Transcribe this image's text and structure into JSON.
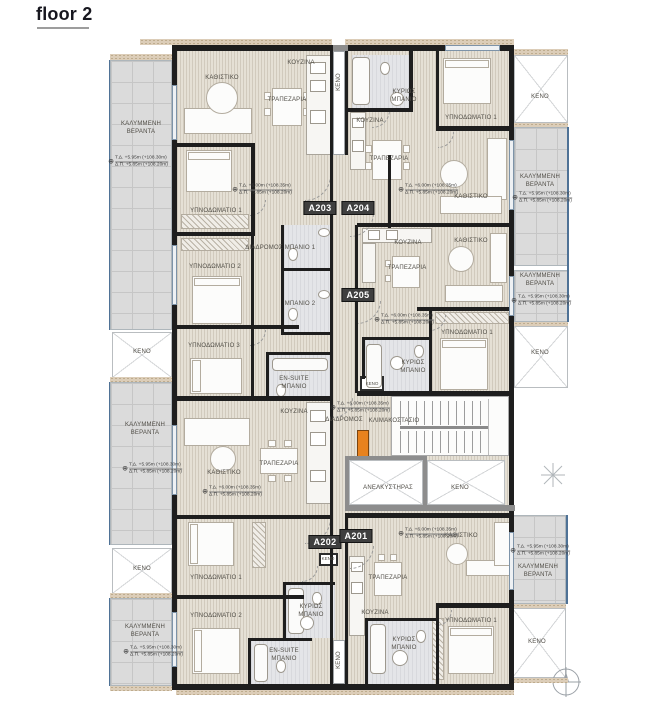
{
  "title": "floor 2",
  "palette": {
    "wall": "#1E1E1E",
    "floor": "#E5E0D5",
    "veranda": "#DBDBDB",
    "bathroom": "#E4E5E8",
    "accent_orange": "#E8821E",
    "badge_bg": "#3F3F3F"
  },
  "level_texts": {
    "interior": [
      "Τ.Δ. +6.00m (+108.35m)",
      "Δ.Π. +5.85m (+108.20m)"
    ],
    "veranda": [
      "Τ.Δ. +5.95m (+108.30m)",
      "Δ.Π. +5.85m (+108.20m)"
    ]
  },
  "badges": [
    {
      "id": "A203",
      "x": 320,
      "y": 208
    },
    {
      "id": "A204",
      "x": 358,
      "y": 208
    },
    {
      "id": "A205",
      "x": 358,
      "y": 295
    },
    {
      "id": "A202",
      "x": 325,
      "y": 542
    },
    {
      "id": "A201",
      "x": 356,
      "y": 536
    }
  ],
  "labels": [
    {
      "t": "ΚΑΘΙΣΤΙΚΟ",
      "x": 222,
      "y": 79
    },
    {
      "t": "ΚΟΥΖΙΝΑ",
      "x": 301,
      "y": 64
    },
    {
      "t": "ΤΡΑΠΕΖΑΡΙΑ",
      "x": 287,
      "y": 101
    },
    {
      "t": "ΥΠΝΟΔΩΜΑΤΙΟ 1",
      "x": 216,
      "y": 212
    },
    {
      "t": "ΥΠΝΟΔΩΜΑΤΙΟ 2",
      "x": 215,
      "y": 268
    },
    {
      "t": "ΥΠΝΟΔΩΜΑΤΙΟ 3",
      "x": 214,
      "y": 347
    },
    {
      "t": "ΔΙΑΔΡΟΜΟΣ",
      "x": 264,
      "y": 249
    },
    {
      "t": "ΜΠΑΝΙΟ 1",
      "x": 300,
      "y": 249
    },
    {
      "t": "ΜΠΑΝΙΟ 2",
      "x": 300,
      "y": 305
    },
    {
      "t": "EN-SUITE\nΜΠΑΝΙΟ",
      "x": 294,
      "y": 384
    },
    {
      "t": "ΚΟΥΖΙΝΑ",
      "x": 370,
      "y": 122
    },
    {
      "t": "ΚΥΡΙΩΣ\nΜΠΑΝΙΟ",
      "x": 404,
      "y": 97
    },
    {
      "t": "ΥΠΝΟΔΩΜΑΤΙΟ 1",
      "x": 471,
      "y": 119
    },
    {
      "t": "ΤΡΑΠΕΖΑΡΙΑ",
      "x": 389,
      "y": 160
    },
    {
      "t": "ΚΑΘΙΣΤΙΚΟ",
      "x": 471,
      "y": 198
    },
    {
      "t": "ΚΟΥΖΙΝΑ",
      "x": 408,
      "y": 244
    },
    {
      "t": "ΚΑΘΙΣΤΙΚΟ",
      "x": 471,
      "y": 242
    },
    {
      "t": "ΤΡΑΠΕΖΑΡΙΑ",
      "x": 407,
      "y": 269
    },
    {
      "t": "ΥΠΝΟΔΩΜΑΤΙΟ 1",
      "x": 467,
      "y": 334
    },
    {
      "t": "ΚΥΡΙΩΣ\nΜΠΑΝΙΟ",
      "x": 413,
      "y": 368
    },
    {
      "t": "ΚΕΝΟ",
      "x": 372,
      "y": 384,
      "s": "tiny"
    },
    {
      "t": "ΔΙΑΔΡΟΜΟΣ",
      "x": 344,
      "y": 421
    },
    {
      "t": "ΚΛΙΜΑΚΟΣΤΑΣΙΟ",
      "x": 394,
      "y": 422
    },
    {
      "t": "ΑΝΕΛΚΥΣΤΗΡΑΣ",
      "x": 388,
      "y": 489
    },
    {
      "t": "ΚΕΝΟ",
      "x": 460,
      "y": 489
    },
    {
      "t": "ΚΕΝΟ",
      "x": 340,
      "y": 82,
      "v": 1
    },
    {
      "t": "ΚΕΝΟ",
      "x": 340,
      "y": 660,
      "v": 1
    },
    {
      "t": "ΚΕΝΟ",
      "x": 328,
      "y": 559,
      "s": "tiny"
    },
    {
      "t": "ΚΟΥΖΙΝΑ",
      "x": 294,
      "y": 413
    },
    {
      "t": "ΤΡΑΠΕΖΑΡΙΑ",
      "x": 279,
      "y": 465
    },
    {
      "t": "ΚΑΘΙΣΤΙΚΟ",
      "x": 224,
      "y": 474
    },
    {
      "t": "ΥΠΝΟΔΩΜΑΤΙΟ 1",
      "x": 216,
      "y": 579
    },
    {
      "t": "ΥΠΝΟΔΩΜΑΤΙΟ 2",
      "x": 216,
      "y": 617
    },
    {
      "t": "ΚΥΡΙΩΣ\nΜΠΑΝΙΟ",
      "x": 311,
      "y": 612
    },
    {
      "t": "EN-SUITE\nΜΠΑΝΙΟ",
      "x": 284,
      "y": 656
    },
    {
      "t": "ΚΑΘΙΣΤΙΚΟ",
      "x": 461,
      "y": 537
    },
    {
      "t": "ΤΡΑΠΕΖΑΡΙΑ",
      "x": 388,
      "y": 579
    },
    {
      "t": "ΚΟΥΖΙΝΑ",
      "x": 375,
      "y": 614
    },
    {
      "t": "ΚΥΡΙΩΣ\nΜΠΑΝΙΟ",
      "x": 404,
      "y": 645
    },
    {
      "t": "ΥΠΝΟΔΩΜΑΤΙΟ 1",
      "x": 471,
      "y": 622
    },
    {
      "t": "ΚΑΛΥΜΜΕΝΗ\nΒΕΡΑΝΤΑ",
      "x": 141,
      "y": 129
    },
    {
      "t": "ΚΕΝΟ",
      "x": 142,
      "y": 353
    },
    {
      "t": "ΚΑΛΥΜΜΕΝΗ\nΒΕΡΑΝΤΑ",
      "x": 145,
      "y": 430
    },
    {
      "t": "ΚΕΝΟ",
      "x": 142,
      "y": 570
    },
    {
      "t": "ΚΑΛΥΜΜΕΝΗ\nΒΕΡΑΝΤΑ",
      "x": 145,
      "y": 632
    },
    {
      "t": "ΚΕΝΟ",
      "x": 540,
      "y": 98
    },
    {
      "t": "ΚΑΛΥΜΜΕΝΗ\nΒΕΡΑΝΤΑ",
      "x": 540,
      "y": 182
    },
    {
      "t": "ΚΑΛΥΜΜΕΝΗ\nΒΕΡΑΝΤΑ",
      "x": 540,
      "y": 281
    },
    {
      "t": "ΚΕΝΟ",
      "x": 540,
      "y": 354
    },
    {
      "t": "ΚΑΛΥΜΜΕΝΗ\nΒΕΡΑΝΤΑ",
      "x": 538,
      "y": 572
    },
    {
      "t": "ΚΕΝΟ",
      "x": 537,
      "y": 643
    }
  ],
  "level_marks": [
    {
      "x": 262,
      "y": 190,
      "k": "interior"
    },
    {
      "x": 428,
      "y": 190,
      "k": "interior"
    },
    {
      "x": 404,
      "y": 320,
      "k": "interior"
    },
    {
      "x": 360,
      "y": 408,
      "k": "interior"
    },
    {
      "x": 232,
      "y": 492,
      "k": "interior"
    },
    {
      "x": 428,
      "y": 534,
      "k": "interior"
    },
    {
      "x": 138,
      "y": 162,
      "k": "veranda"
    },
    {
      "x": 152,
      "y": 469,
      "k": "veranda"
    },
    {
      "x": 153,
      "y": 652,
      "k": "veranda"
    },
    {
      "x": 542,
      "y": 198,
      "k": "veranda"
    },
    {
      "x": 541,
      "y": 301,
      "k": "veranda"
    },
    {
      "x": 540,
      "y": 551,
      "k": "veranda"
    }
  ]
}
